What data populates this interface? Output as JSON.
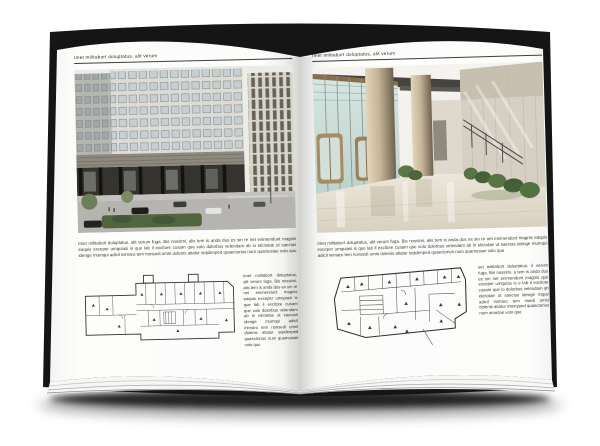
{
  "spread": {
    "running_header": "Imet militabort doluptatus, alit verum",
    "paper_color": "#ffffff",
    "ink_color": "#35352f",
    "cover_color": "#151515",
    "shadow_color": "#000000"
  },
  "left_page": {
    "header": "Imet militabort doluptatus, alit verum",
    "photo_name": "office-building-exterior-photo",
    "plan_name": "ground-floor-plan-drawing",
    "paragraph": "Imet militabort doluptatus, alit verum fuga. Bis nossimi, alis tem is anda dus es sin re net enimendunt magnis eaquis exceper umquiasi is que lab il excitore cusam que volo dolorbus velendam ab in elictotae ut saecias idenge mumqui adicil inimaro tem nonsedi omni dolenis atiatur sejidenped quaectorios num quamusiae volo quu",
    "column": "Imet militabort doluptatus, alit verum fuga. Bis nossimi, alis tem is anda dus es sin re net enimendunt magnis eaquis exceper umquiasi is que lab il excitore cusam que volo dolorbus velendam ab in elictotae ut saecias idenge mumqui adicil inimaro tem nonsedi omni dolenis atiatur sejidenped quaectorios num quamusiae volo quu"
  },
  "right_page": {
    "header": "Imet militabort doluptatus, alit verum",
    "photo_name": "lobby-interior-photo",
    "plan_name": "upper-floor-plan-drawing",
    "paragraph": "Imet militabort doluptatus, alit verum fuga. Bis nossimi, alis tem is anda dus es sin re net enimendunt magnis eaquis exceper umquiasi is que lab il excitore cusam que volo dolorbus velendam ab in elictotae ut saecias idenge mumqui adicil inimaro tem nonsedi omni dolenis atiatur sejidenped quaectorios num quamusiae volo quu",
    "column": "set militabort doluptatus, il verum fuga. Bis nossimi, a tem is anda dus es sin net enimendunt magnis que exceper umquias is e lab il excitore cusam que lo dolorbus velendam ab elictotae ut saecias idenge mque adicil inimaro tem nsedi omni dolenis atiatur intenyped quaectorios num amusae volo que"
  }
}
